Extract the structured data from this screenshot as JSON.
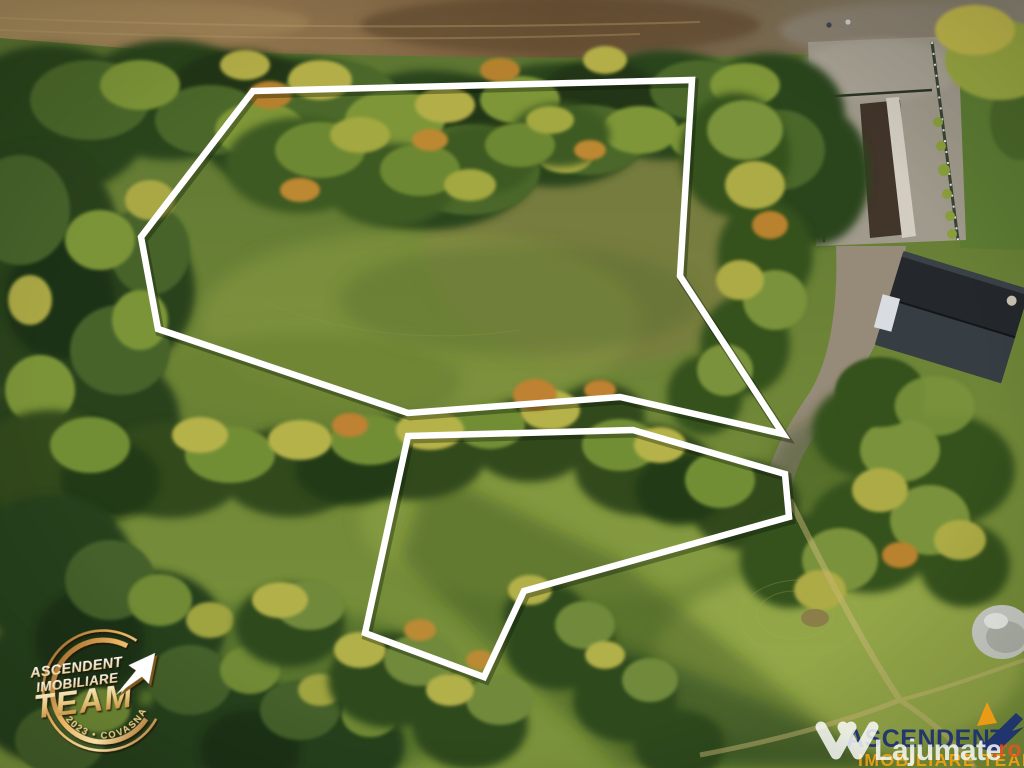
{
  "parcels": {
    "outline_color": "#ffffff",
    "upper": {
      "points": "253,91 692,80 680,276 783,434 620,397 408,413 158,329 141,237"
    },
    "lower": {
      "points": "408,436 633,430 785,474 789,517 524,591 484,677 365,633"
    }
  },
  "badge": {
    "title": "ASCENDENT",
    "subtitle": "IMOBILIARE",
    "team": "TEAM",
    "arc": "2023 • COVASNA",
    "gold": "#d49a4e"
  },
  "watermark_right": {
    "agency_name": "ASCENDENT",
    "agency_subtitle": "IMOBILIARE TEAM",
    "agency_name_color": "#1b2f72",
    "agency_subtitle_color": "#f0a213",
    "site_brand": "Lajumate",
    "site_tld": ".ro",
    "site_brand_color": "#ffffff",
    "site_tld_color": "#ef5023"
  }
}
